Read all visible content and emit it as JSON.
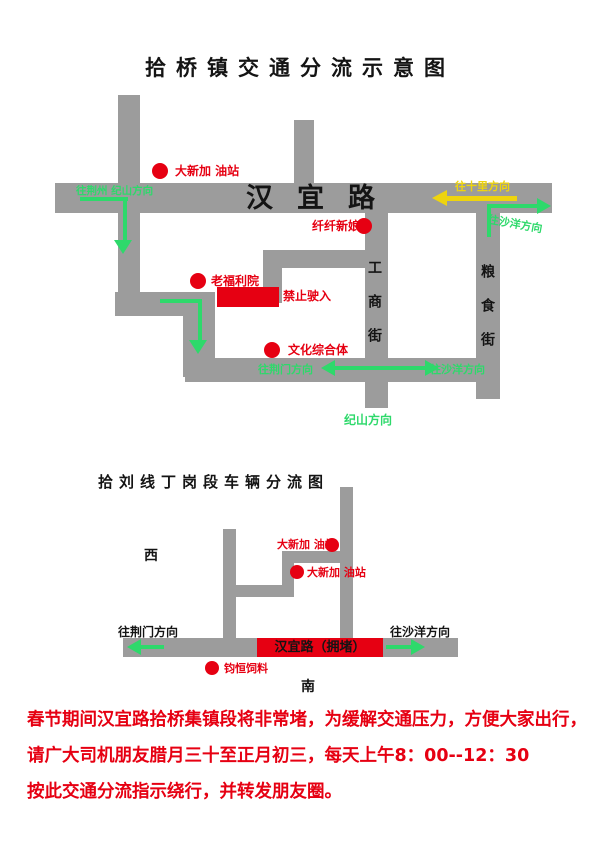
{
  "colors": {
    "road_gray": "#9c9c9c",
    "accent_red": "#e60012",
    "arrow_green": "#2ed96b",
    "arrow_yellow": "#eed40e",
    "text_black": "#141414"
  },
  "map1": {
    "title": "拾桥镇交通分流示意图",
    "road_name": "汉宜路",
    "streets": {
      "gongshang": "工商街",
      "liangshi": "粮食街"
    },
    "pois": {
      "gas_station": "大新加 油站",
      "bride_shop": "纤纤新娘",
      "welfare_home": "老福利院",
      "culture_complex": "文化综合体"
    },
    "no_entry": "禁止驶入",
    "directions": {
      "to_jingzhou_jishan": "往荆州 纪山方向",
      "to_shili": "往十里方向",
      "to_shayang_east": "往沙洋方向",
      "to_jingmen": "往荆门方向",
      "to_shayang_south": "往沙洋方向",
      "jishan": "纪山方向"
    }
  },
  "map2": {
    "title": "拾刘线丁岗段车辆分流图",
    "compass": {
      "west": "西",
      "south": "南"
    },
    "pois": {
      "gas_station_1": "大新加 油站",
      "gas_station_2": "大新加 油站",
      "feed_store": "钧恒饲料"
    },
    "congested_road": "汉宜路（拥堵）",
    "directions": {
      "to_jingmen": "往荆门方向",
      "to_shayang": "往沙洋方向"
    }
  },
  "notice": {
    "lines": [
      "春节期间汉宜路拾桥集镇段将非常堵，为缓解交通压力，方便大家出行，",
      "请广大司机朋友腊月三十至正月初三，每天上午8：00--12：30",
      "按此交通分流指示绕行，并转发朋友圈。"
    ]
  }
}
